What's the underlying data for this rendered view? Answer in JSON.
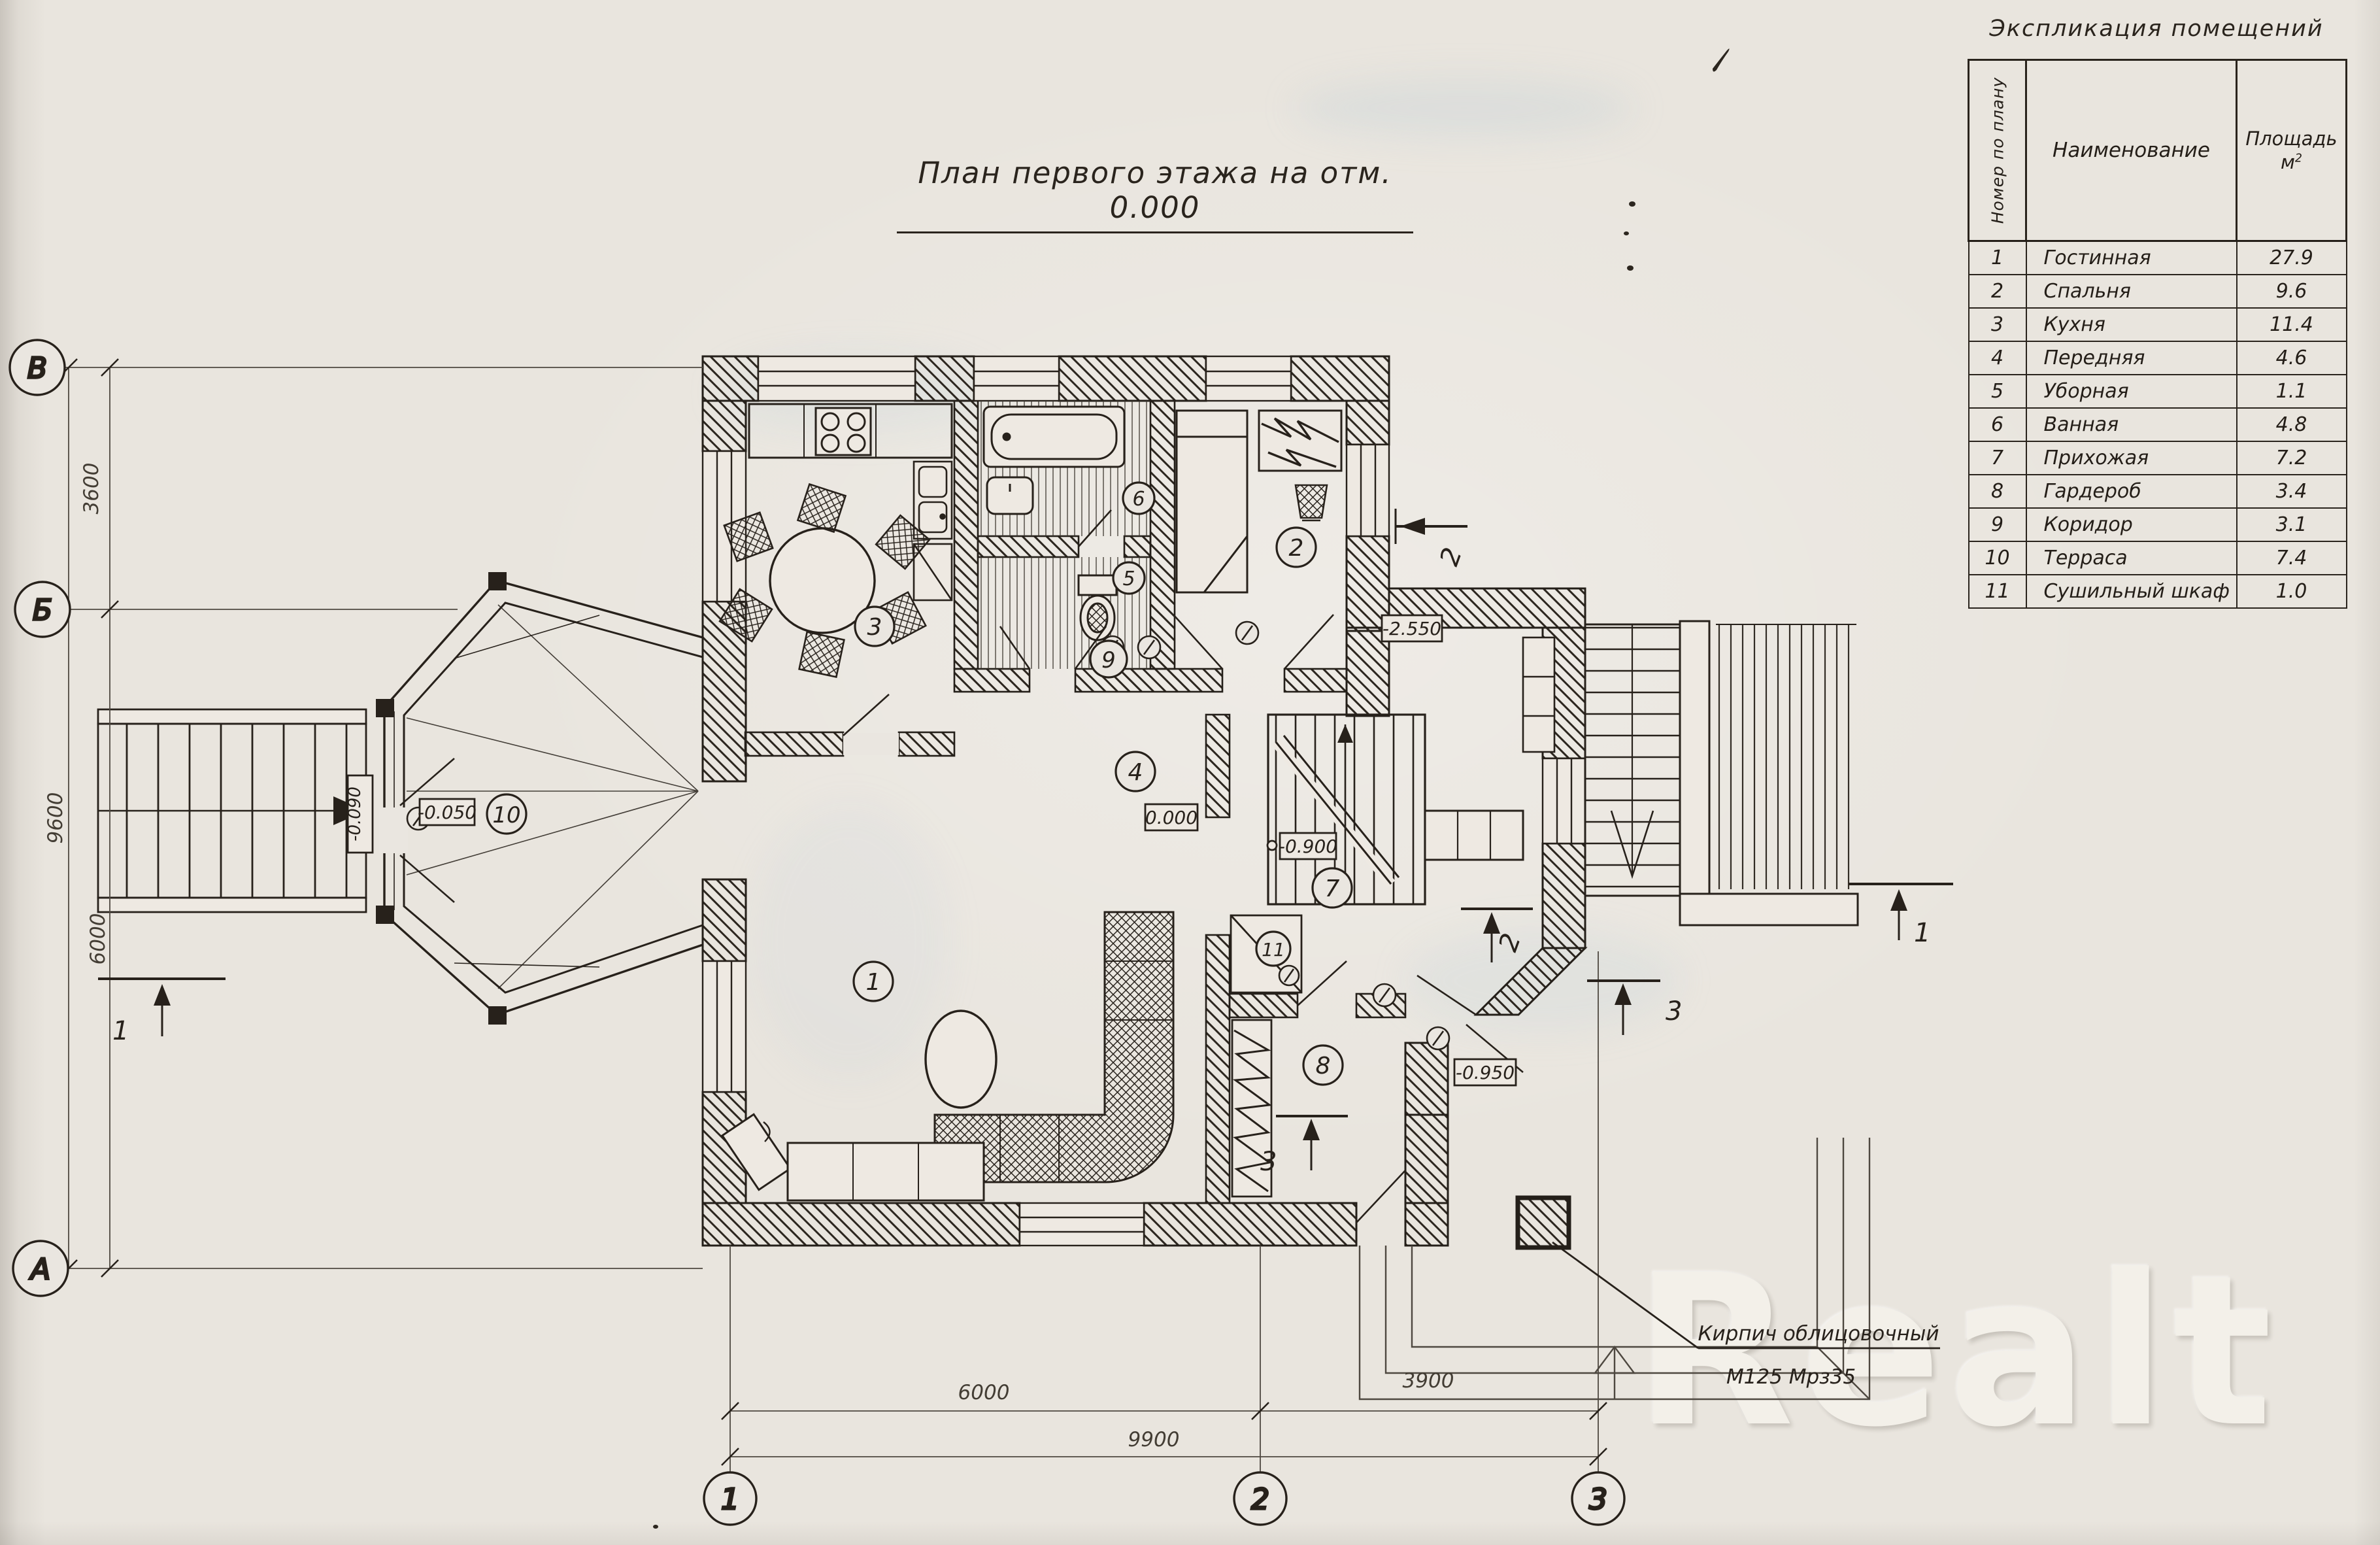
{
  "page": {
    "title": "План первого этажа на отм. 0.000",
    "watermark": "Realt"
  },
  "legend_table": {
    "title": "Экспликация помещений",
    "col_number": "Номер по плану",
    "col_name": "Наименование",
    "col_area": "Площадь",
    "col_area_unit_base": "м",
    "col_area_unit_sup": "2",
    "rows": [
      {
        "num": "1",
        "name": "Гостинная",
        "area": "27.9"
      },
      {
        "num": "2",
        "name": "Спальня",
        "area": "9.6"
      },
      {
        "num": "3",
        "name": "Кухня",
        "area": "11.4"
      },
      {
        "num": "4",
        "name": "Передняя",
        "area": "4.6"
      },
      {
        "num": "5",
        "name": "Уборная",
        "area": "1.1"
      },
      {
        "num": "6",
        "name": "Ванная",
        "area": "4.8"
      },
      {
        "num": "7",
        "name": "Прихожая",
        "area": "7.2"
      },
      {
        "num": "8",
        "name": "Гардероб",
        "area": "3.4"
      },
      {
        "num": "9",
        "name": "Коридор",
        "area": "3.1"
      },
      {
        "num": "10",
        "name": "Терраса",
        "area": "7.4"
      },
      {
        "num": "11",
        "name": "Сушильный шкаф",
        "area": "1.0"
      }
    ]
  },
  "plan": {
    "axes_left": [
      "В",
      "Б",
      "А"
    ],
    "axes_bottom": [
      "1",
      "2",
      "3"
    ],
    "dims_left": [
      "3600",
      "9600",
      "6000"
    ],
    "dims_bottom": [
      "6000",
      "3900",
      "9900"
    ],
    "room_numbers": [
      "1",
      "2",
      "3",
      "4",
      "5",
      "6",
      "7",
      "8",
      "9",
      "10",
      "11"
    ],
    "elevations": {
      "terrace": "-0.050",
      "entry": "-0.090",
      "floor": "0.000",
      "stair": "-0.900",
      "backstair": "-2.550",
      "porch": "-0.950"
    },
    "sections": {
      "s1": "1",
      "s2": "2",
      "s3": "3"
    },
    "annotation": {
      "line1": "Кирпич облицовочный",
      "line2": "М125 Мрз35"
    }
  },
  "colors": {
    "paper": "#eae6e0",
    "ink": "#27211b",
    "pencil": "#4e4840",
    "watermark": "#f4f1eb"
  }
}
